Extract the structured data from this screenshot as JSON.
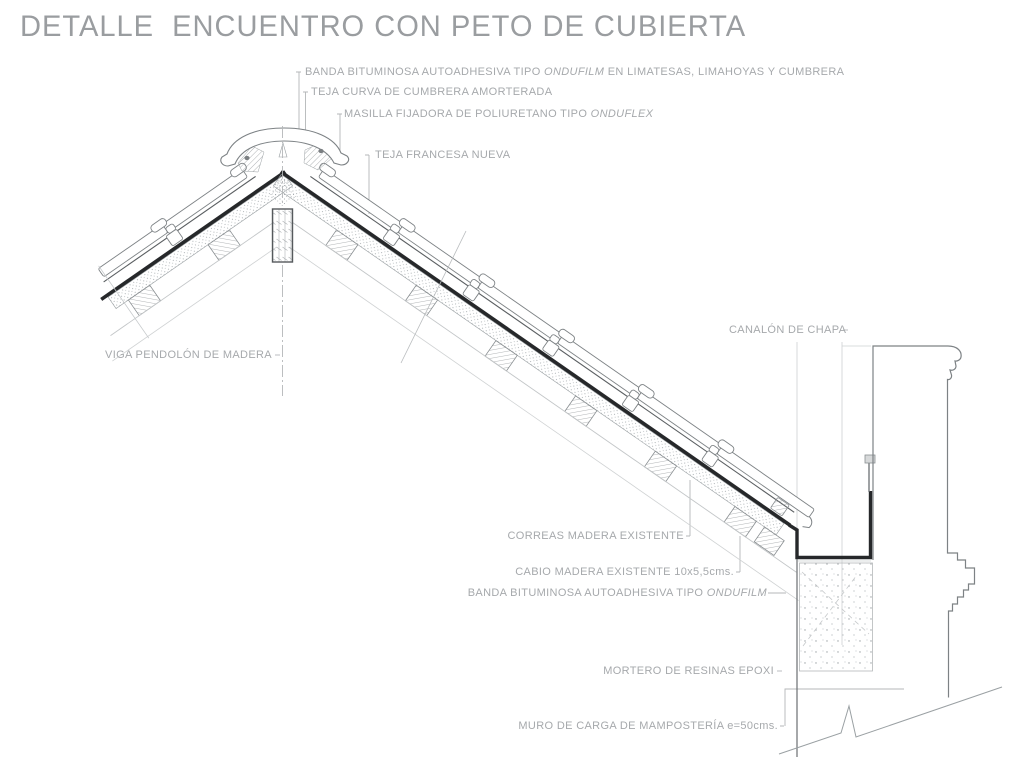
{
  "title": "DETALLE  ENCUENTRO CON PETO DE CUBIERTA",
  "labels": {
    "banda_cumbrera": {
      "prefix": "BANDA BITUMINOSA AUTOADHESIVA TIPO ",
      "brand": "ONDUFILM",
      "suffix": " EN LIMATESAS, LIMAHOYAS Y CUMBRERA"
    },
    "teja_curva": "TEJA CURVA DE CUMBRERA AMORTERADA",
    "masilla": {
      "prefix": "MASILLA FIJADORA DE POLIURETANO TIPO ",
      "brand": "ONDUFLEX",
      "suffix": ""
    },
    "teja_francesa": "TEJA FRANCESA NUEVA",
    "viga_pendolon": "VIGA PENDOLÓN DE MADERA",
    "canalon": "CANALÓN DE CHAPA",
    "correas": "CORREAS MADERA EXISTENTE",
    "cabio": "CABIO MADERA EXISTENTE 10x5,5cms.",
    "banda_eaves": {
      "prefix": "BANDA BITUMINOSA AUTOADHESIVA TIPO ",
      "brand": "ONDUFILM",
      "suffix": ""
    },
    "mortero": "MORTERO DE RESINAS EPOXI",
    "muro": "MURO DE CARGA DE MAMPOSTERÍA e=50cms."
  },
  "colors": {
    "line": "#85898c",
    "dark_band": "#26282a",
    "label_text": "#a6a9ac",
    "title_text": "#9a9da0",
    "light_line": "#c6c9cb",
    "background": "#ffffff"
  }
}
